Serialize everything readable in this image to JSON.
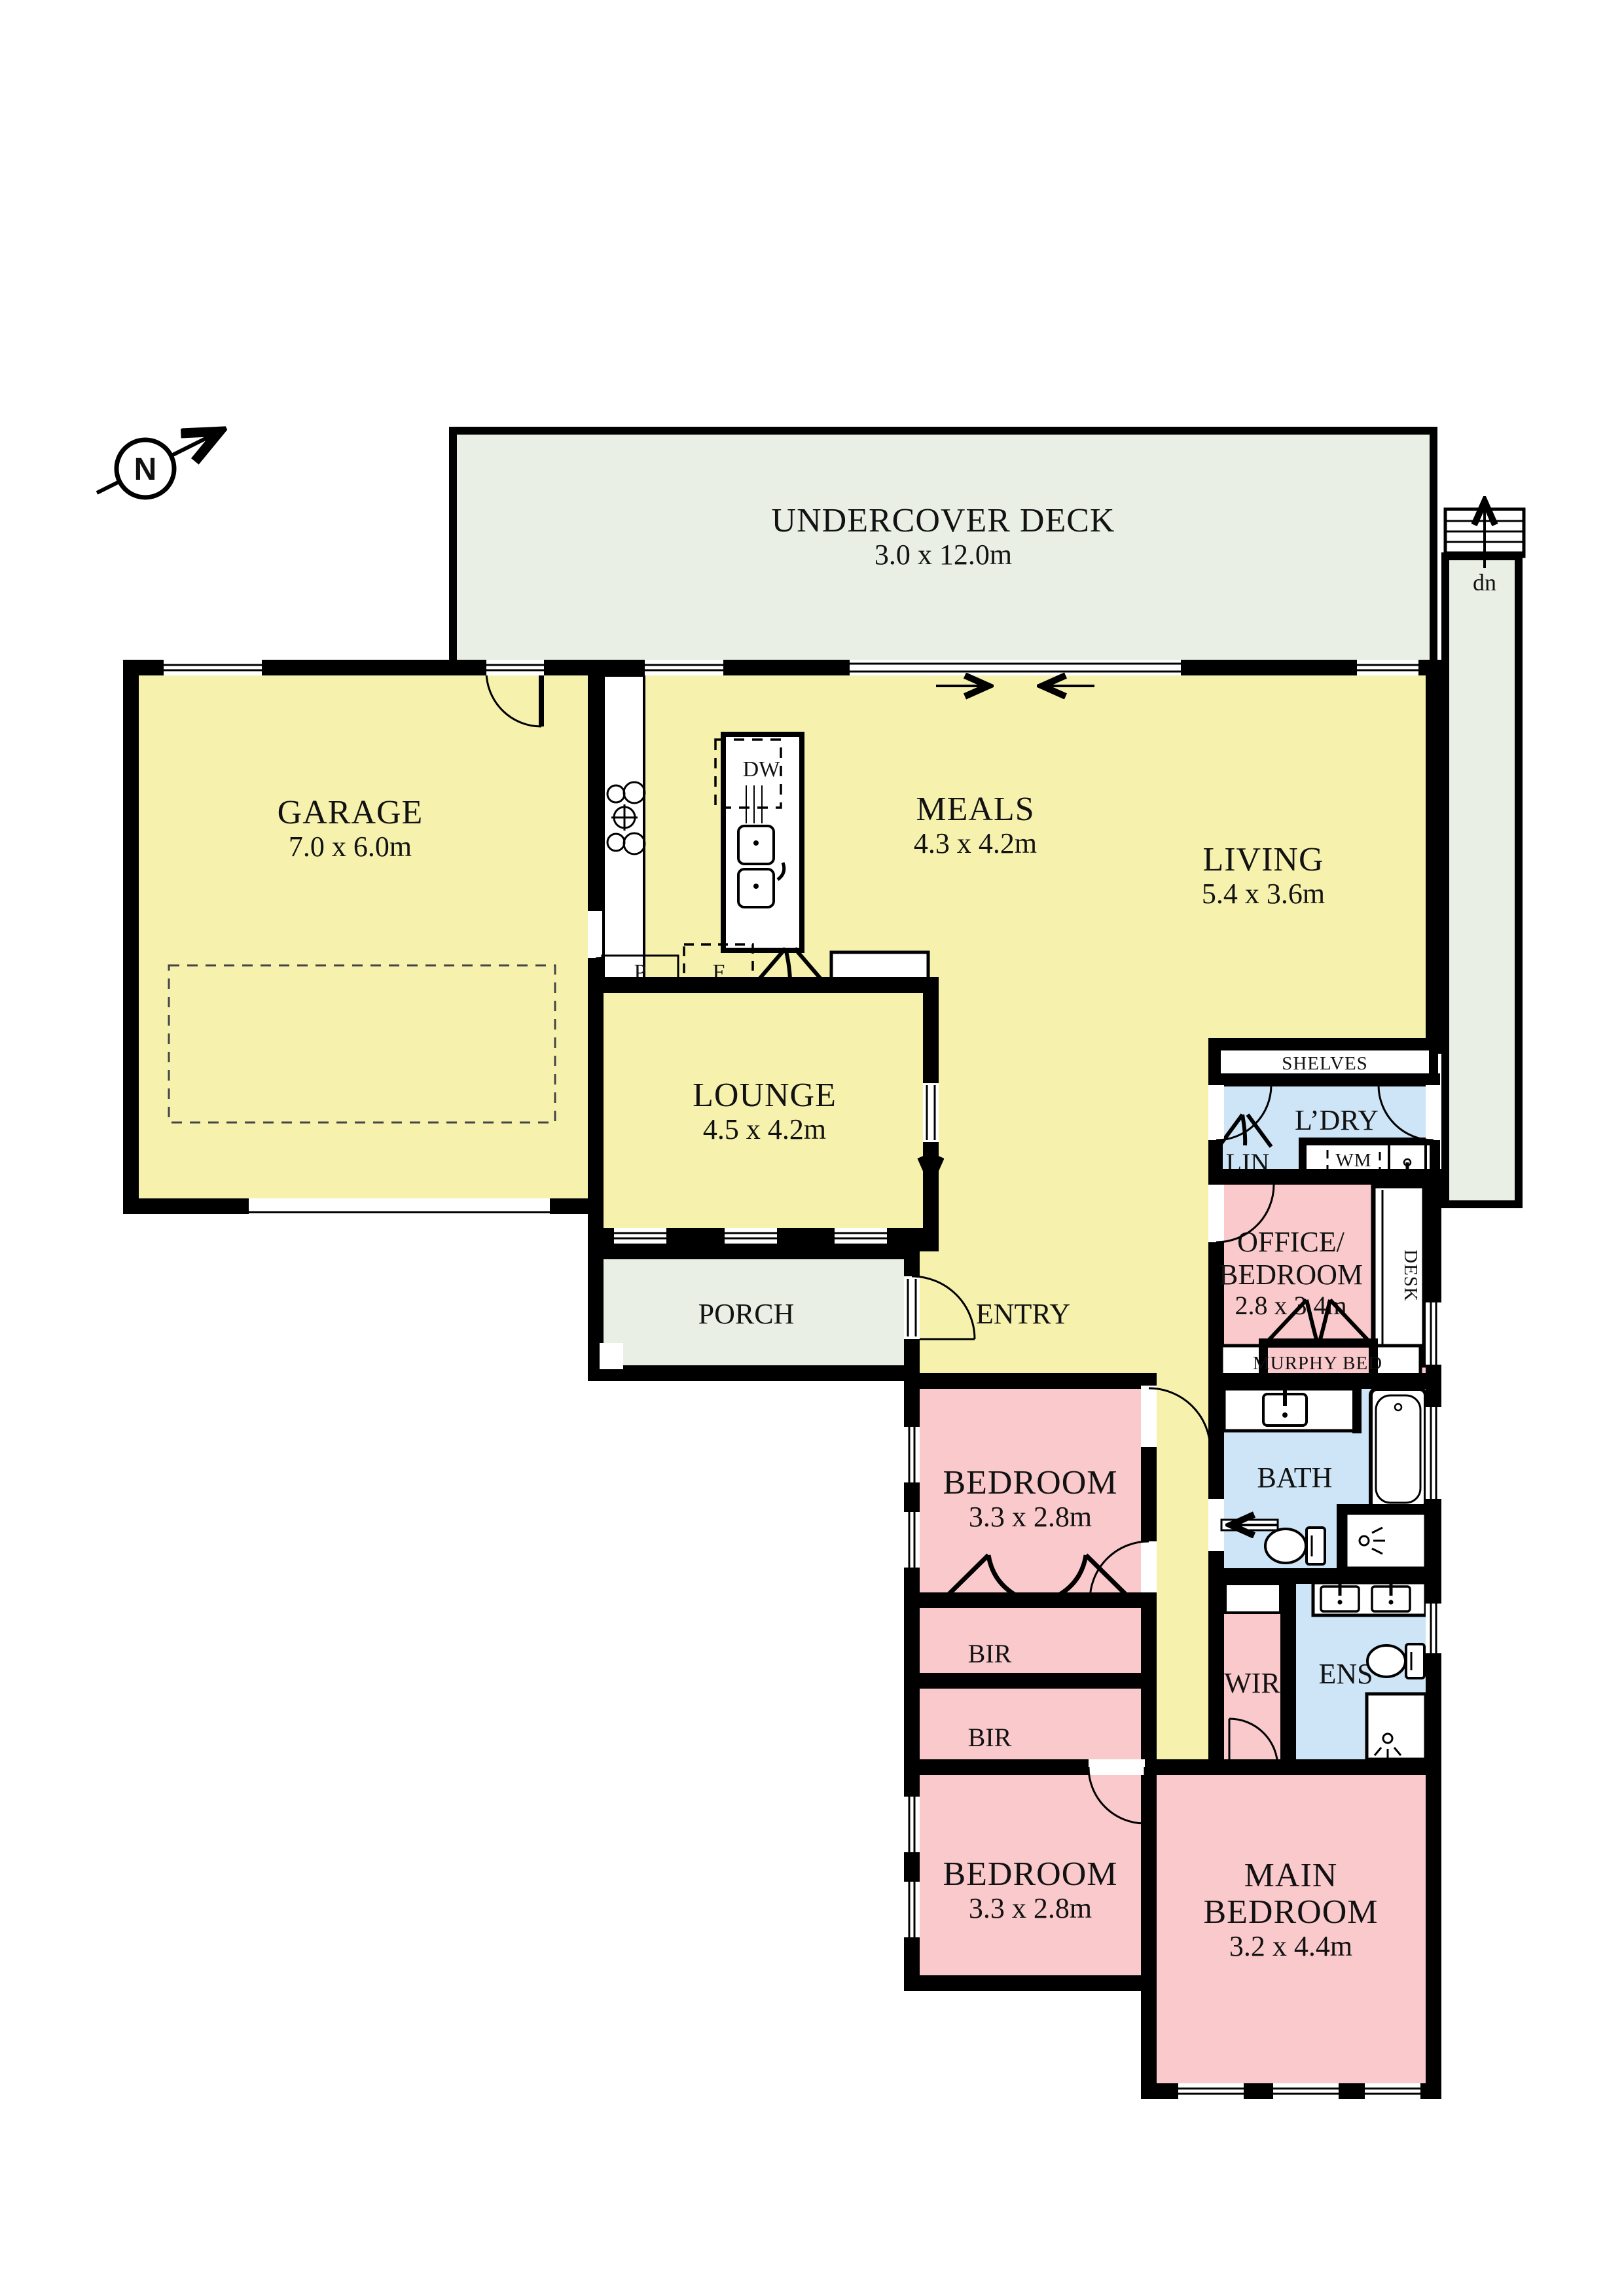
{
  "compass": {
    "label": "N"
  },
  "outdoor": {
    "deck": {
      "name": "UNDERCOVER DECK",
      "dims": "3.0 x 12.0m"
    },
    "stairs_label": "dn"
  },
  "rooms": {
    "garage": {
      "name": "GARAGE",
      "dims": "7.0 x 6.0m"
    },
    "meals": {
      "name": "MEALS",
      "dims": "4.3 x 4.2m"
    },
    "living": {
      "name": "LIVING",
      "dims": "5.4 x 3.6m"
    },
    "lounge": {
      "name": "LOUNGE",
      "dims": "4.5 x 4.2m"
    },
    "porch": {
      "name": "PORCH"
    },
    "entry": {
      "name": "ENTRY"
    },
    "laundry": {
      "name": "L’DRY"
    },
    "linen": {
      "name": "LIN"
    },
    "office": {
      "name_line1": "OFFICE/",
      "name_line2": "BEDROOM",
      "dims": "2.8 x 3.4m"
    },
    "bath": {
      "name": "BATH"
    },
    "bedroom2": {
      "name": "BEDROOM",
      "dims": "3.3 x 2.8m"
    },
    "bedroom3": {
      "name": "BEDROOM",
      "dims": "3.3 x 2.8m"
    },
    "wir": {
      "name": "WIR"
    },
    "ens": {
      "name": "ENS"
    },
    "main_bedroom": {
      "name_line1": "MAIN",
      "name_line2": "BEDROOM",
      "dims": "3.2 x 4.4m"
    }
  },
  "fixtures": {
    "dishwasher": "DW",
    "washing_machine": "WM",
    "fridge": "F",
    "pantry1": "P",
    "pantry2": "P",
    "shelves": "SHELVES",
    "desk": "DESK",
    "murphy_bed": "MURPHY BED",
    "bir1": "BIR",
    "bir2": "BIR"
  },
  "colors": {
    "wall": "#000000",
    "living_zone": "#f6f2ae",
    "bedroom_zone": "#f9c9cc",
    "wet_zone": "#cde5f7",
    "outdoor_zone": "#e9efe5",
    "background": "#ffffff"
  }
}
